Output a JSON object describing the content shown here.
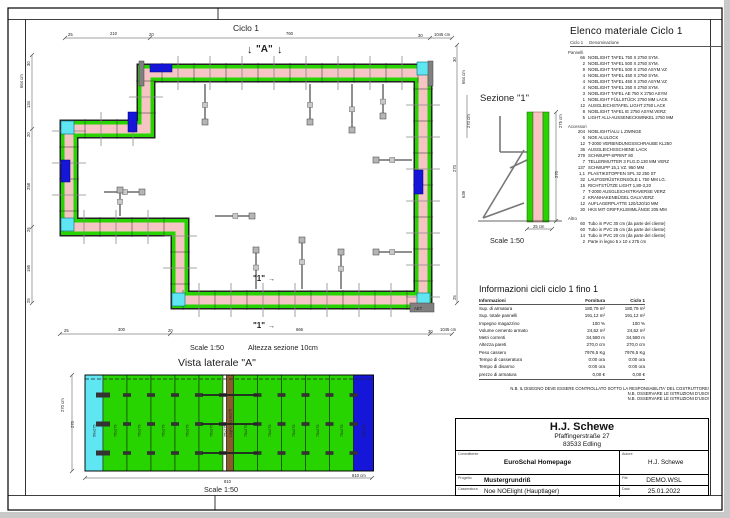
{
  "page": {
    "header_label": "Ciclo 1"
  },
  "plan": {
    "marker_a": "\"A\"",
    "marker_a_arrow": "↓",
    "marker_1": "\"1\"",
    "marker_1_arrow": "→",
    "corner_block_label": "AET",
    "scale_note": "Scale 1:50",
    "section_height_note": "Altezza sezione 10cm",
    "dims": {
      "top": [
        "25",
        "210",
        "20",
        "760",
        "30",
        "1045 cm"
      ],
      "left": [
        "30",
        "664 cm",
        "134",
        "20",
        "258",
        "26",
        "195",
        "25"
      ],
      "right": [
        "30",
        "664 cm",
        "270 cm",
        "270",
        "639",
        "25"
      ],
      "bottom": [
        "25",
        "300",
        "20",
        "666",
        "30",
        "1045 cm"
      ]
    }
  },
  "lateral_view": {
    "title": "Vista laterale \"A\"",
    "scale": "Scale 1:50",
    "panels": [
      {
        "label": "50x275",
        "type": "cyan"
      },
      {
        "label": "75x275",
        "type": "green"
      },
      {
        "label": "75x275",
        "type": "green"
      },
      {
        "label": "75x275",
        "type": "green"
      },
      {
        "label": "75x275",
        "type": "green"
      },
      {
        "label": "75x275",
        "type": "green"
      },
      {
        "label": "25x275",
        "type": "gap"
      },
      {
        "label": "Legno 5x10x275",
        "type": "timber"
      },
      {
        "label": "75x275",
        "type": "green"
      },
      {
        "label": "75x275",
        "type": "green"
      },
      {
        "label": "75x275",
        "type": "green"
      },
      {
        "label": "75x275",
        "type": "green"
      },
      {
        "label": "75x275",
        "type": "green"
      },
      {
        "label": "45x275",
        "type": "blue"
      }
    ],
    "dims": {
      "left": [
        "270 cm",
        "270"
      ],
      "bottom": [
        "810",
        "810 cm"
      ]
    }
  },
  "section_view": {
    "title": "Sezione \"1\"",
    "scale": "Scale 1:50",
    "dims": [
      "275 cm",
      "270",
      "25 cm"
    ]
  },
  "material_list": {
    "title": "Elenco materiale  Ciclo 1",
    "header": {
      "cycle": "Ciclo 1",
      "name": "Denominazione"
    },
    "groups": [
      {
        "name": "Pannelli",
        "items": [
          [
            "66",
            "NOELIGHT TAFEL 750 X 2750 SYM."
          ],
          [
            "2",
            "NOELIGHT TAFEL 500 X 2750 SYM."
          ],
          [
            "9",
            "NOELIGHT TAFEL 500 X 2750 ASYM.VZ"
          ],
          [
            "4",
            "NOELIGHT TAFEL 450 X 2750 SYM."
          ],
          [
            "4",
            "NOELIGHT TAFEL 450 X 2750 ASYM.VZ"
          ],
          [
            "4",
            "NOELIGHT TAFEL 250 X 2750 SYM."
          ],
          [
            "3",
            "NOELIGHT TAFEL AE 750 X 2750 ASYM"
          ],
          [
            "1",
            "NOELIGHT FÜLLSTÜCK 2750 MM LACK"
          ],
          [
            "12",
            "AUSGLEICHSTAFEL LIGHT 2750 LACK"
          ],
          [
            "8",
            "NOELIGHT TAFEL IE 2750 ASYM.VERZ"
          ],
          [
            "5",
            "LIGHT ALU-AUSSENECKWINKEL 2750 MM"
          ]
        ]
      },
      {
        "name": "Accessori",
        "items": [
          [
            "204",
            "NOELIGHT/ALU L ZWINGE"
          ],
          [
            "6",
            "NOE ALULOCK"
          ],
          [
            "12",
            "T-2000 VERBINDUNGSSCHRAUBE KL250"
          ],
          [
            "36",
            "AUSGLEICHSSCHIENE LACK"
          ],
          [
            "279",
            "SCHWUPP-SPRINT 80"
          ],
          [
            "7",
            "TELLERMUTTER 3 FLG.D.130 MM VERZ"
          ],
          [
            "137",
            "SCHWUPP 15,1  VZ. 950 MM"
          ],
          [
            "1,1",
            "PLASTIKSTOPFEN SPL 32 250 ST"
          ],
          [
            "32",
            "LAUFGERÜSTKONSOLE L 750 MM LG."
          ],
          [
            "15",
            "RICHTSTÜTZE LIGHT 1,80-3,20"
          ],
          [
            "7",
            "T-2000 AUSGLEICHSTRAVERSE VERZ"
          ],
          [
            "2",
            "KRANHAKENBÜGEL GALV.VERZ"
          ],
          [
            "12",
            "AUFLAGERPLATTE 120/120/10 MM"
          ],
          [
            "30",
            "HKS MIT GRIFF,KLEMMLÄNGE 205 MM"
          ]
        ]
      },
      {
        "name": "Altro",
        "items": [
          [
            "60",
            "Tubo in PVC 30 cm (da parte del cliente)"
          ],
          [
            "60",
            "Tubo in PVC 25 cm (da parte del cliente)"
          ],
          [
            "14",
            "Tubo in PVC 20 cm (da parte del cliente)"
          ],
          [
            "2",
            "Parte in legno 5 x 10 x 275 cm"
          ]
        ]
      }
    ]
  },
  "info_table": {
    "title": "Informazioni cicli  ciclo 1 fino 1",
    "columns": [
      "Informazioni",
      "Fornitura",
      "Ciclo 1"
    ],
    "rows": [
      [
        "Sup. di armatura",
        "180,79 m²",
        "180,79 m²"
      ],
      [
        "Sup. totale pannelli",
        "191,12 m²",
        "191,12 m²"
      ],
      [
        "Impegno magazzino",
        "100 %",
        "100 %"
      ],
      [
        "Volume cemento armato",
        "24,62 m³",
        "24,62 m³"
      ],
      [
        "Metri correnti",
        "34,580 m",
        "34,580 m"
      ],
      [
        "Altezza pareti",
        "270,0 cm",
        "270,0 cm"
      ],
      [
        "Peso cassero",
        "7976,5 Kg",
        "7976,5 Kg"
      ],
      [
        "Tempo di casseratura",
        "0:00 ora",
        "0:00 ora"
      ],
      [
        "Tempo di disarmo",
        "0:00 ora",
        "0:00 ora"
      ],
      [
        "prezzo di armatura",
        "0,00 €",
        "0,00 €"
      ]
    ]
  },
  "notes": [
    "N.B. IL DISEGNO DEVE ESSERE CONTROLLATO SOTTO LA RESPONSABILITA' DEL COSTRUTTORE!",
    "N.B. OSSERVARE LE ISTRUZIONI D'USO!",
    "N.B. OSSERVARE LE ISTRUZIONI D'USO!"
  ],
  "title_block": {
    "company": "H.J. Schewe",
    "address1": "Pfaffingerstraße 27",
    "address2": "83533 Edling",
    "committente_label": "Committente",
    "committente_value": "EuroSchal Homepage",
    "autore_label": "Autore",
    "autore_value": "H.J. Schewe",
    "progetto_label": "Progetto",
    "progetto_value": "Mustergrundriß",
    "file_label": "File",
    "file_value": "DEMO.WSL",
    "casseratura_label": "Casseratura",
    "casseratura_value": "Noe NOElight (Hauptlager)",
    "data_label": "Data",
    "data_value": "25.01.2022"
  },
  "colors": {
    "panel_green": "#28d400",
    "panel_cyan": "#5fe6f2",
    "panel_blue": "#1616d8",
    "concrete_pink": "#f6c4c4",
    "timber_brown": "#8a5a2a",
    "prop_gray": "#909090"
  }
}
